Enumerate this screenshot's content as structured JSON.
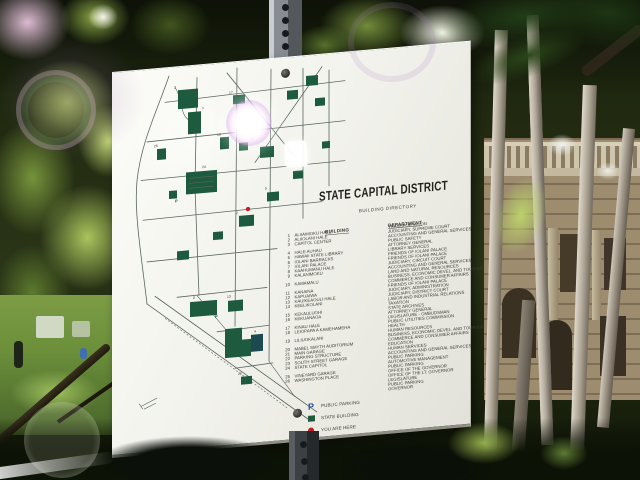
{
  "sign": {
    "title": "STATE CAPITAL DISTRICT",
    "subtitle": "BUILDING DIRECTORY",
    "columns": {
      "building": "BUILDING",
      "department": "DEPARTMENT"
    },
    "buildings": [
      {
        "num": "1",
        "name": "ALIIAIMOKU HALE",
        "gap": false
      },
      {
        "num": "2",
        "name": "ALIIOLANI HALE",
        "gap": false
      },
      {
        "num": "3",
        "name": "CAPITOL CENTER",
        "gap": false
      },
      {
        "num": "4",
        "name": "HALE AUHAU",
        "gap": true
      },
      {
        "num": "5",
        "name": "HAWAII STATE LIBRARY",
        "gap": false
      },
      {
        "num": "6",
        "name": "IOLANI BARRACKS",
        "gap": false
      },
      {
        "num": "7",
        "name": "IOLANI PALACE",
        "gap": false
      },
      {
        "num": "8",
        "name": "KAAHUMANU HALE",
        "gap": false
      },
      {
        "num": "9",
        "name": "KALANIMOKU",
        "gap": false
      },
      {
        "num": "10",
        "name": "KAMAMALU",
        "gap": true
      },
      {
        "num": "11",
        "name": "KANAINA",
        "gap": true
      },
      {
        "num": "12",
        "name": "KAPUAIWA",
        "gap": false
      },
      {
        "num": "13",
        "name": "KAUIKEAOULI HALE",
        "gap": false
      },
      {
        "num": "14",
        "name": "KEELIKOLANI",
        "gap": false
      },
      {
        "num": "15",
        "name": "KEKAULUOHI",
        "gap": true
      },
      {
        "num": "16",
        "name": "KEKUANAOA",
        "gap": false
      },
      {
        "num": "17",
        "name": "KINAU HALE",
        "gap": true
      },
      {
        "num": "18",
        "name": "LEIOPAPA A KAMEHAMEHA",
        "gap": false
      },
      {
        "num": "19",
        "name": "LILIUOKALANI",
        "gap": true
      },
      {
        "num": "20",
        "name": "MABEL SMYTH AUDITORIUM",
        "gap": true
      },
      {
        "num": "21",
        "name": "MAIN GARAGE",
        "gap": false
      },
      {
        "num": "22",
        "name": "PARKING STRUCTURE",
        "gap": false
      },
      {
        "num": "23",
        "name": "SOUTH STREET GARAGE",
        "gap": false
      },
      {
        "num": "24",
        "name": "STATE CAPITOL",
        "gap": false
      },
      {
        "num": "25",
        "name": "VINEYARD GARAGE",
        "gap": true
      },
      {
        "num": "26",
        "name": "WASHINGTON PLACE",
        "gap": false
      }
    ],
    "departments": [
      "TRANSPORTATION",
      "JUDICIARY, SUPREME COURT",
      "ACCOUNTING AND GENERAL SERVICES",
      "PUBLIC SAFETY",
      "ATTORNEY GENERAL",
      "LIBRARY SERVICES",
      "FRIENDS OF IOLANI PALACE",
      "FRIENDS OF IOLANI PALACE",
      "JUDICIARY, CIRCUIT COURT",
      "ACCOUNTING AND GENERAL SERVICES",
      "LAND AND NATURAL RESOURCES",
      "BUSINESS, ECONOMIC DEVEL. AND TOURISM",
      "COMMERCE AND CONSUMER AFFAIRS",
      "FRIENDS OF IOLANI PALACE",
      "JUDICIARY, ADMINISTRATION",
      "JUDICIARY, DISTRICT COURT",
      "LABOR AND INDUSTRIAL RELATIONS",
      "TAXATION",
      "STATE ARCHIVES",
      "ATTORNEY GENERAL",
      "LEGISLATURE - OMBUDSMAN",
      "PUBLIC UTILITIES COMMISSION",
      "HEALTH",
      "HUMAN RESOURCES",
      "BUSINESS, ECONOMIC DEVEL. AND TOURISM",
      "COMMERCE AND CONSUMER AFFAIRS",
      "EDUCATION",
      "HUMAN SERVICES",
      "ACCOUNTING AND GENERAL SERVICES",
      "PUBLIC PARKING",
      "AUTOMOTIVE MANAGEMENT",
      "PUBLIC PARKING",
      "OFFICE OF THE GOVERNOR",
      "OFFICE OF THE LT. GOVERNOR",
      "LEGISLATURE",
      "PUBLIC PARKING",
      "GOVERNOR"
    ],
    "legend": [
      {
        "type": "parking",
        "symbol": "P",
        "label": "PUBLIC PARKING",
        "color": "#2b4e9e"
      },
      {
        "type": "state-building",
        "symbol": "square",
        "label": "STATE BUILDING",
        "color": "#1d5a3e"
      },
      {
        "type": "you-are-here",
        "symbol": "dot",
        "label": "YOU ARE HERE",
        "color": "#c0202a"
      }
    ]
  },
  "map": {
    "building_color": "#1d5a3e",
    "street_color": "#5a675f",
    "you_are_here_color": "#c0202a",
    "parking_color": "#2b4e9e",
    "labels": [
      {
        "n": "3",
        "x": 57,
        "y": 19
      },
      {
        "n": "1",
        "x": 85,
        "y": 42
      },
      {
        "n": "17",
        "x": 112,
        "y": 29
      },
      {
        "n": "26",
        "x": 37,
        "y": 76
      },
      {
        "n": "24",
        "x": 85,
        "y": 101
      },
      {
        "n": "18",
        "x": 100,
        "y": 70
      },
      {
        "n": "10",
        "x": 133,
        "y": 77
      },
      {
        "n": "5",
        "x": 148,
        "y": 128
      },
      {
        "n": "2",
        "x": 119,
        "y": 150
      },
      {
        "n": "8",
        "x": 76,
        "y": 231
      },
      {
        "n": "13",
        "x": 110,
        "y": 233
      },
      {
        "n": "4",
        "x": 137,
        "y": 270
      },
      {
        "n": "22",
        "x": 121,
        "y": 311
      }
    ],
    "parking_marks": [
      {
        "x": 58,
        "y": 133
      },
      {
        "x": 98,
        "y": 252
      }
    ]
  }
}
